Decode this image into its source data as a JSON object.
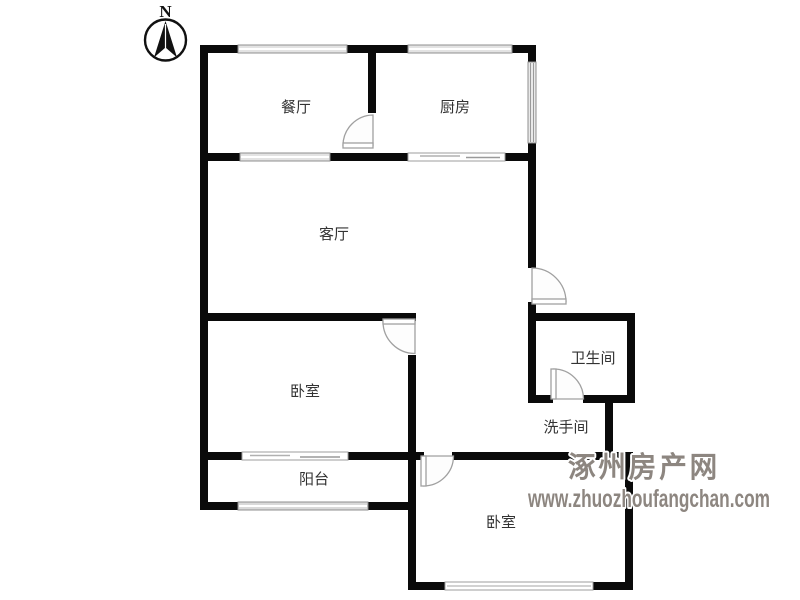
{
  "compass": {
    "north_label": "N"
  },
  "rooms": {
    "dining": {
      "label": "餐厅"
    },
    "kitchen": {
      "label": "厨房"
    },
    "living": {
      "label": "客厅"
    },
    "bedroom_left": {
      "label": "卧室"
    },
    "bathroom": {
      "label": "卫生间"
    },
    "washroom": {
      "label": "洗手间"
    },
    "balcony": {
      "label": "阳台"
    },
    "bedroom_bottom": {
      "label": "卧室"
    }
  },
  "watermark": {
    "site_name": "涿州房产网",
    "url": "www.zhuozhoufangchan.com"
  },
  "colors": {
    "wall": "#0a0a0a",
    "label": "#333333",
    "door": "#a0a0a0",
    "window_edge": "#8f8f8f",
    "watermark": "#8d8680"
  }
}
